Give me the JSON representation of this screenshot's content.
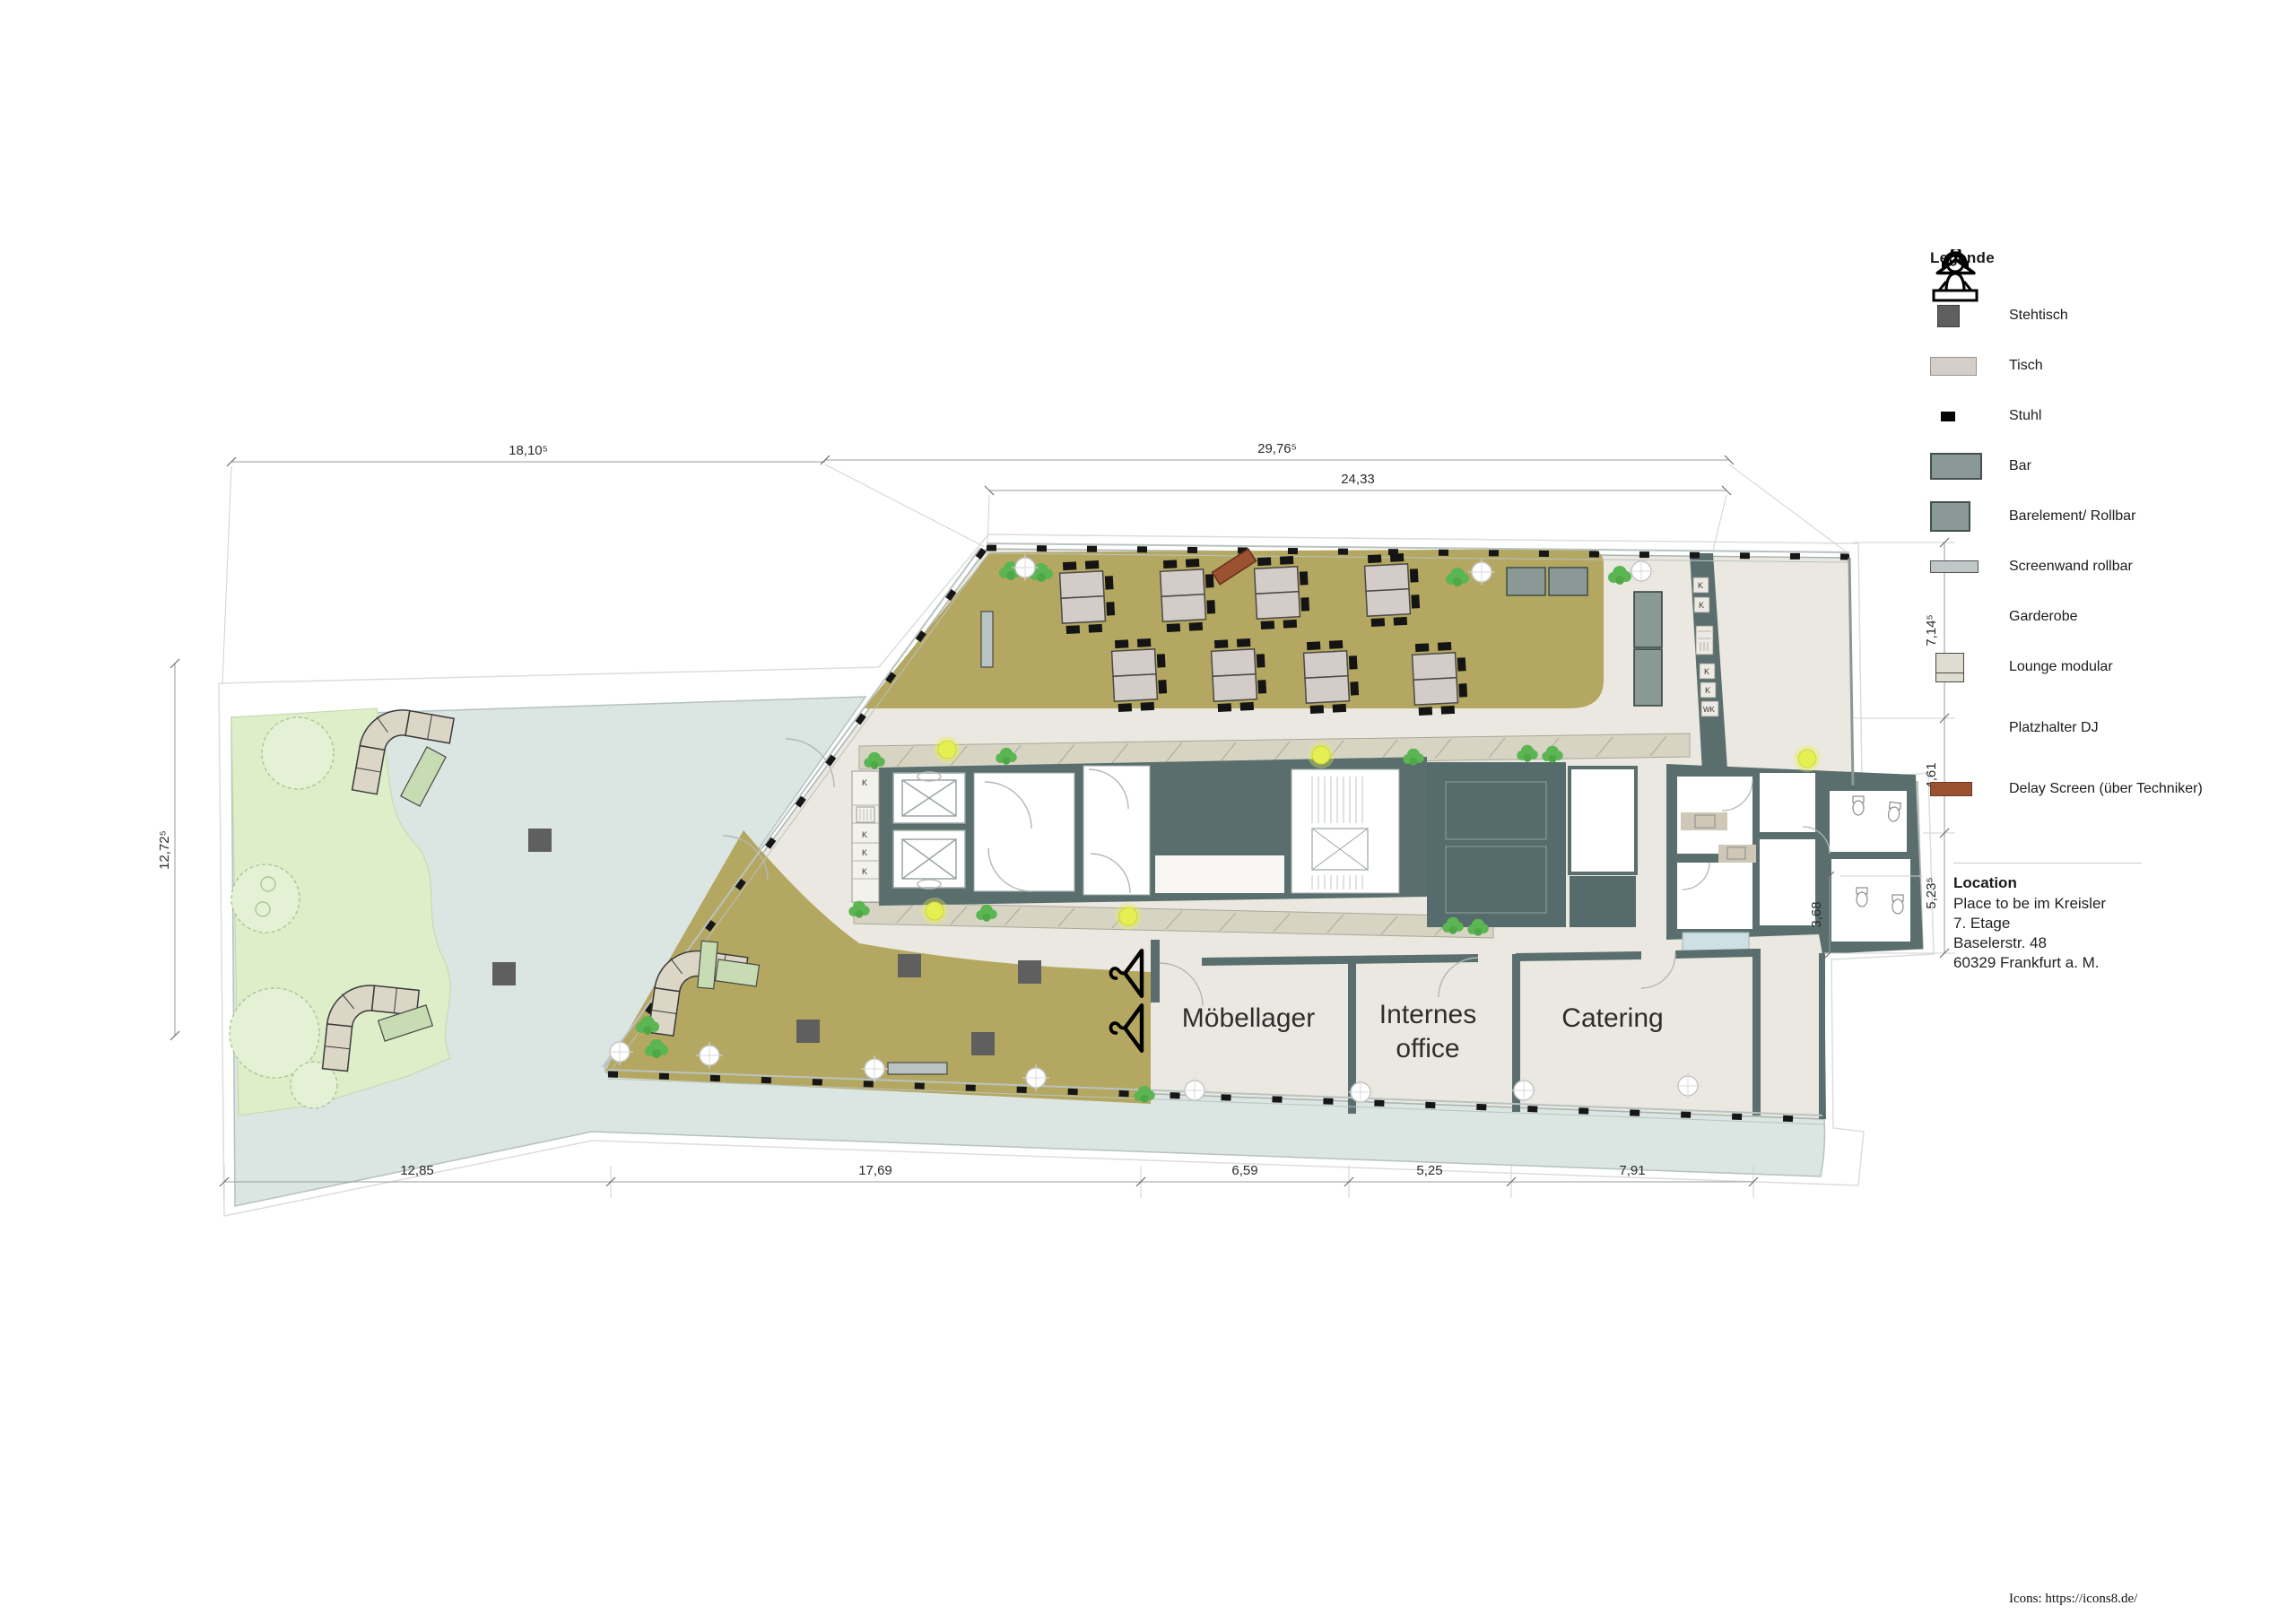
{
  "legend": {
    "title": "Legende",
    "items": [
      {
        "id": "stehtisch",
        "label": "Stehtisch"
      },
      {
        "id": "tisch",
        "label": "Tisch"
      },
      {
        "id": "stuhl",
        "label": "Stuhl"
      },
      {
        "id": "bar",
        "label": "Bar"
      },
      {
        "id": "barelement",
        "label": "Barelement/ Rollbar"
      },
      {
        "id": "screenwand",
        "label": "Screenwand rollbar"
      },
      {
        "id": "garderobe",
        "label": "Garderobe"
      },
      {
        "id": "lounge",
        "label": "Lounge modular"
      },
      {
        "id": "dj",
        "label": "Platzhalter DJ"
      },
      {
        "id": "delay",
        "label": "Delay Screen (über Techniker)"
      }
    ]
  },
  "location": {
    "title": "Location",
    "lines": [
      "Place to be im Kreisler",
      "7. Etage",
      "Baselerstr. 48",
      "60329 Frankfurt a. M."
    ]
  },
  "rooms": {
    "moebellager": "Möbellager",
    "internes_line1": "Internes",
    "internes_line2": "office",
    "catering": "Catering"
  },
  "dimensions": {
    "top_left": "18,10⁵",
    "top_right": "29,76⁵",
    "top_inner": "24,33",
    "left": "12,72⁵",
    "right_1": "7,14⁵",
    "right_2": "4,61",
    "right_3": "5,23⁵",
    "right_4": "3,68",
    "bottom_1": "12,85",
    "bottom_2": "17,69",
    "bottom_3": "6,59",
    "bottom_4": "5,25",
    "bottom_5": "7,91"
  },
  "core_labels": {
    "left": [
      "K",
      "K",
      "K",
      "K"
    ],
    "right": [
      "K",
      "K",
      "K",
      "K",
      "WK"
    ]
  },
  "footer": "Icons: https://icons8.de/",
  "colors": {
    "olive_floor": "#b4a761",
    "light_floor": "#eae8e0",
    "terrace": "#dbe5e2",
    "green_area": "#ddeec9",
    "wall": "#5a6e6e",
    "bar": "#8a9995",
    "screenwand": "#c0c8c7",
    "lounge": "#dbd6c6",
    "delay_screen": "#9b5231",
    "stehtisch": "#5f5f5f",
    "tisch": "#d4ccc8"
  }
}
